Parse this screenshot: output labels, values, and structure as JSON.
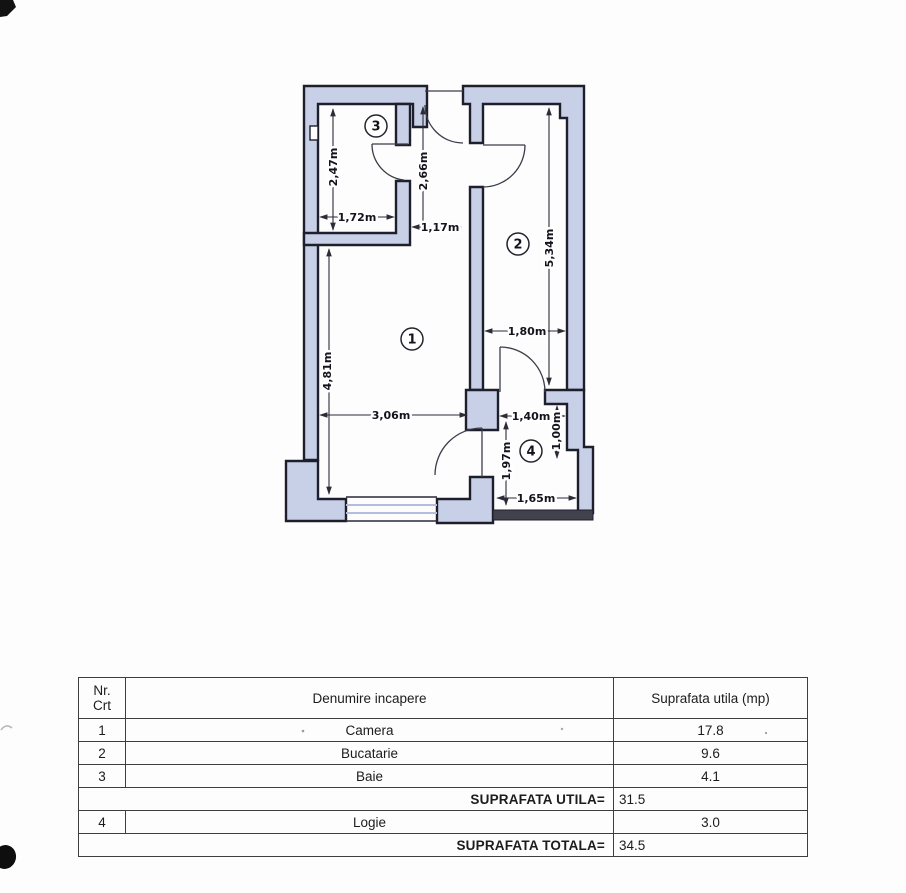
{
  "plan": {
    "room_markers": [
      {
        "num": "1"
      },
      {
        "num": "2"
      },
      {
        "num": "3"
      },
      {
        "num": "4"
      }
    ],
    "dims": {
      "baie_height": "2,47m",
      "baie_width": "1,72m",
      "hall_height": "2,66m",
      "hall_width": "1,17m",
      "camera_height": "4,81m",
      "camera_width": "3,06m",
      "bucatarie_height": "5,34m",
      "bucatarie_width": "1,80m",
      "logie_top_width": "1,40m",
      "logie_left_height": "1,97m",
      "logie_right_height": "1,00m",
      "logie_bottom_width": "1,65m"
    },
    "colors": {
      "wall_fill": "#c7d0e7",
      "wall_outline": "#1e1e2d"
    }
  },
  "table": {
    "headers": {
      "nr": "Nr.",
      "crt": "Crt",
      "name": "Denumire incapere",
      "area": "Suprafata utila (mp)"
    },
    "rows": [
      {
        "nr": "1",
        "name": "Camera",
        "area": "17.8"
      },
      {
        "nr": "2",
        "name": "Bucatarie",
        "area": "9.6"
      },
      {
        "nr": "3",
        "name": "Baie",
        "area": "4.1"
      }
    ],
    "subtotal": {
      "label": "SUPRAFATA UTILA=",
      "value": "31.5"
    },
    "rows2": [
      {
        "nr": "4",
        "name": "Logie",
        "area": "3.0"
      }
    ],
    "total": {
      "label": "SUPRAFATA TOTALA=",
      "value": "34.5"
    }
  }
}
